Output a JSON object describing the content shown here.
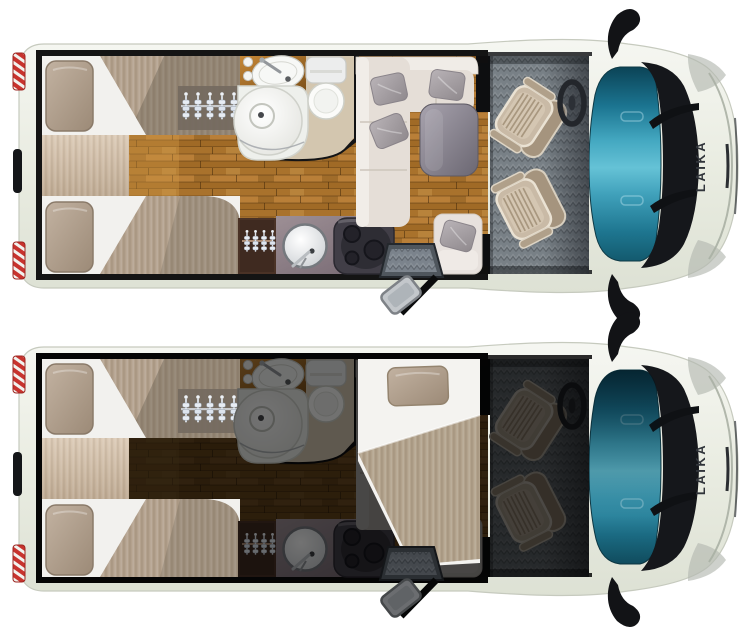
{
  "brand": "LAIKA",
  "floorplans": [
    {
      "id": "day",
      "variant": "daytime-layout"
    },
    {
      "id": "night",
      "variant": "nighttime-layout"
    }
  ],
  "colors": {
    "body": "#eef0e8",
    "body_edge": "#c6cabe",
    "windshield_teal": "#2d93b0",
    "windshield_deep": "#0b4356",
    "trim_black": "#15171b",
    "wood": "#b07a36",
    "wood_night": "#2e1f0e",
    "bath_floor": "#d3c6af",
    "counter_wood": "#b5752c",
    "mattress": "#f2f1ee",
    "blanket": "#b3a18d",
    "pillow": "#b5a494",
    "bench": "#d3c2ae",
    "sofa": "#e5ded7",
    "pillow_gray": "#a8a2a6",
    "table_gray": "#8b8691",
    "carpet": "#788086",
    "seat": "#c9baa6",
    "cabinet": "#4a3226",
    "counter_gray": "#8d7e84",
    "hob": "#413e47",
    "taillight_red": "#c8332e",
    "step_gray": "#4f565d"
  }
}
